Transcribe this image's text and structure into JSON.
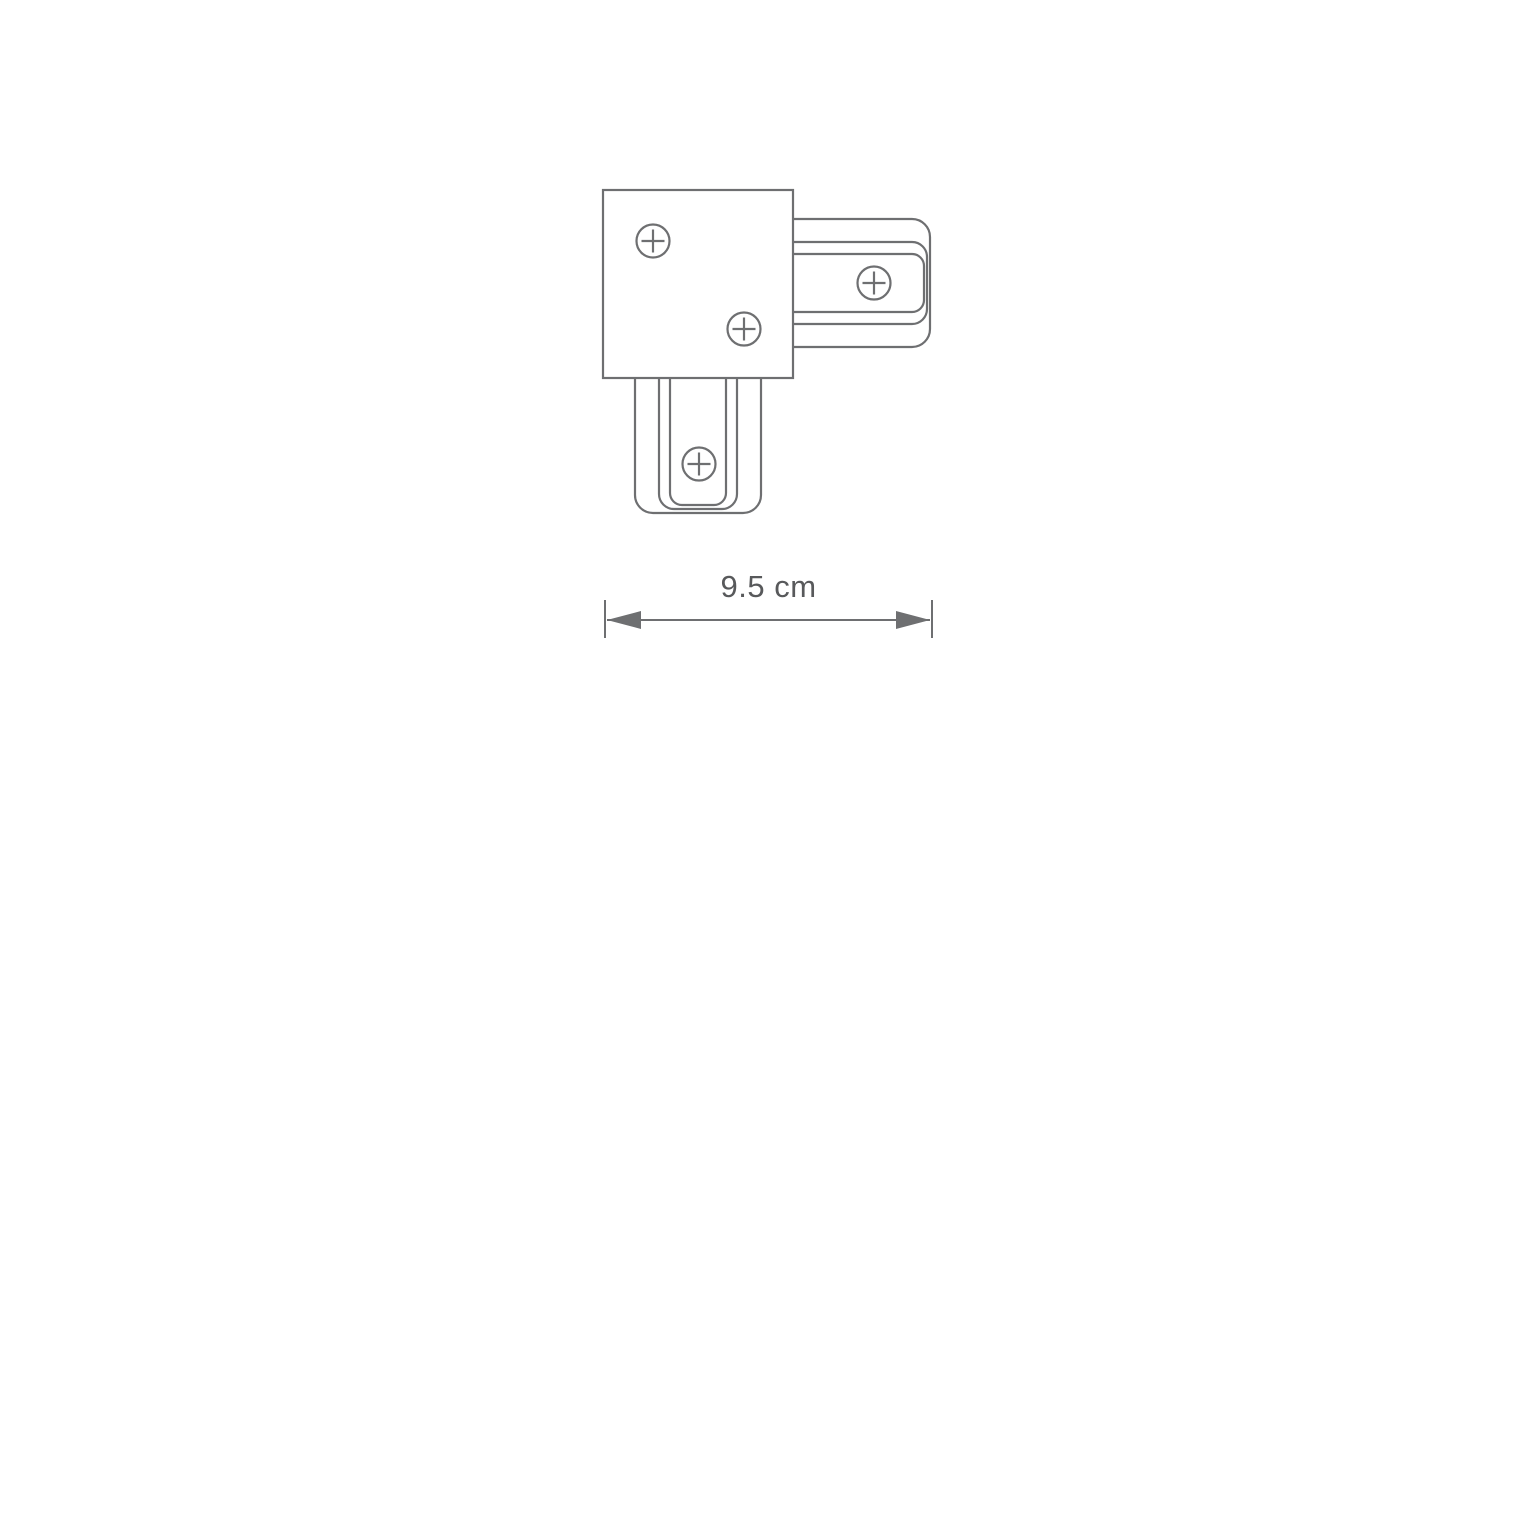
{
  "drawing": {
    "subject": "L-shaped track connector, top view technical outline",
    "colors": {
      "line": "#6e6f71",
      "label": "#58595b",
      "background": "#ffffff"
    },
    "icons": {
      "screw": "crosshead-screw-icon"
    },
    "dimension": {
      "label": "9.5 cm"
    }
  }
}
